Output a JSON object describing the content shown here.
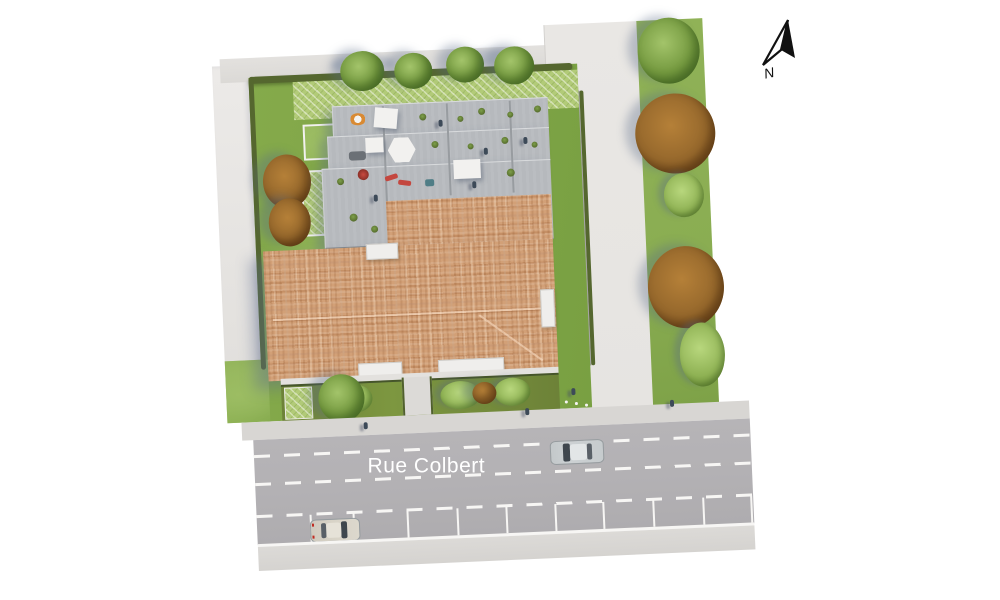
{
  "title": "Residential site plan aerial render",
  "street": {
    "label": "Rue Colbert"
  },
  "compass": {
    "label": "N"
  },
  "colors": {
    "bg": "#ffffff",
    "lawn": "#85aa4b",
    "lawn-light": "#9cbd63",
    "hatch-green": "#b2cb78",
    "hedge": "#55672f",
    "deck": "#b6b9bd",
    "deck-edge": "#83878b",
    "roof": "#d2a077",
    "band": "#e7e5e2",
    "path": "#e6e4e1",
    "driveway": "#a8a6a9",
    "greenstrip": "#8aad52",
    "asphalt": "#b3b1b4",
    "sidewalk": "#d8d6d3",
    "sidewalk-2": "#dcdad7",
    "line-white": "#f7f6f4",
    "tree-green": "#74993f",
    "tree-green-light": "#a3c46a",
    "tree-autumn": "#96682c",
    "tree-autumn-dark": "#6e471c",
    "car-silver": "#ccd1d3",
    "car-beige": "#d8d3c7",
    "glass": "#3e464d",
    "shadow": "rgba(90,105,135,0.35)",
    "accent-red": "#c4473f",
    "canopy-white": "#f2f1ef",
    "ink": "#111111"
  }
}
